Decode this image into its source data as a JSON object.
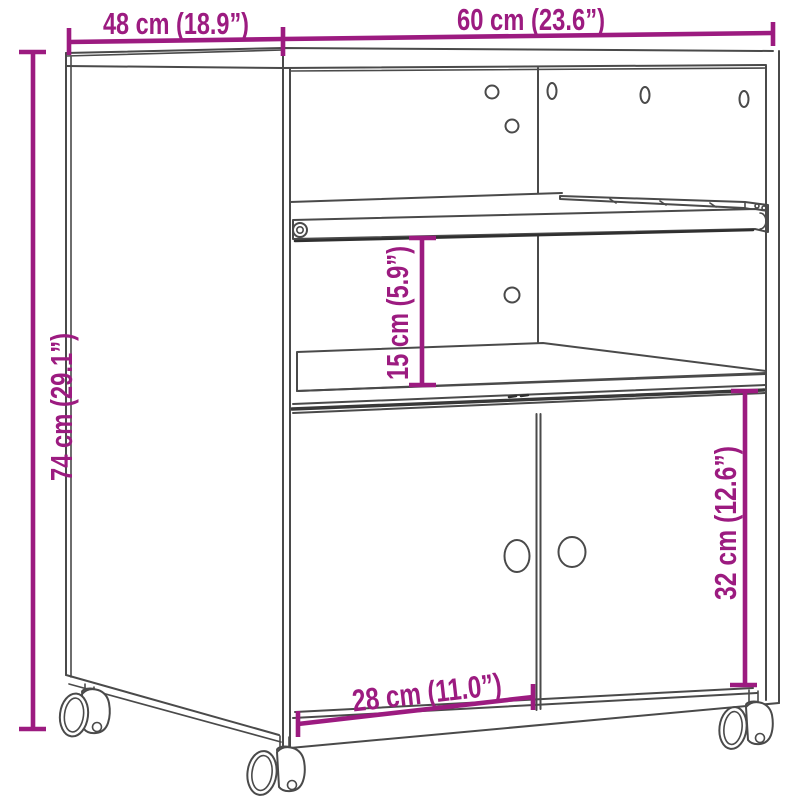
{
  "diagram": {
    "type": "furniture-dimension-drawing",
    "labels": {
      "top_depth": "48 cm (18.9”)",
      "top_width": "60 cm (23.6”)",
      "left_height": "74 cm (29.1”)",
      "middle_shelf": "15 cm (5.9”)",
      "right_door": "32 cm (12.6”)",
      "bottom_door": "28 cm (11.0”)"
    },
    "colors": {
      "dimension_accent": "#9c1b80",
      "outline": "#4a4a4a",
      "background": "#ffffff"
    }
  }
}
